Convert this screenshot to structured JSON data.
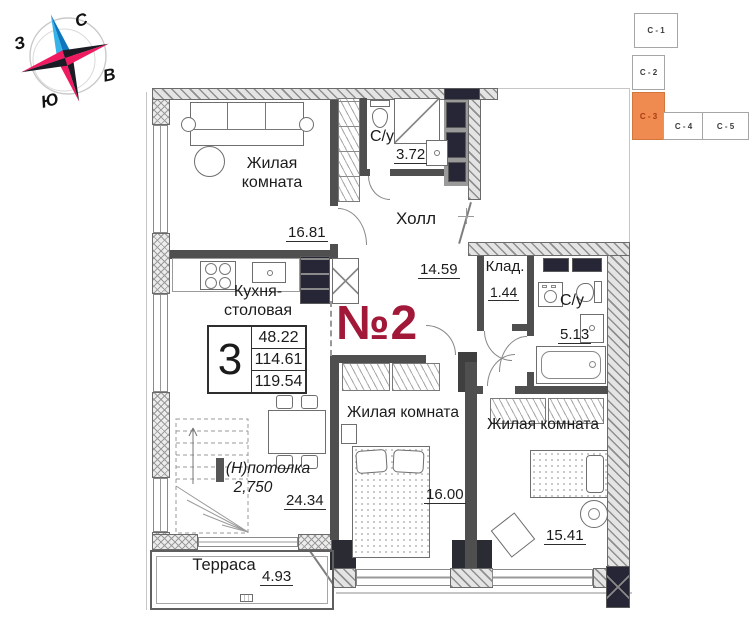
{
  "compass": {
    "north": "С",
    "west": "З",
    "east": "В",
    "south": "Ю"
  },
  "building_scheme": {
    "sections": [
      {
        "label": "С - 1",
        "active": false
      },
      {
        "label": "С - 2",
        "active": false
      },
      {
        "label": "С - 3",
        "active": true
      },
      {
        "label": "С - 4",
        "active": false
      },
      {
        "label": "С - 5",
        "active": false
      }
    ],
    "active_color": "#ef8a50"
  },
  "plan": {
    "apartment_number": "№2",
    "accent_color": "#a21838",
    "rooms": {
      "living1": {
        "label": "Жилая комната",
        "area": "16.81"
      },
      "bath1": {
        "label": "С/у",
        "area": "3.72"
      },
      "hall": {
        "label": "Холл",
        "area": "14.59"
      },
      "storage": {
        "label": "Клад.",
        "area": "1.44"
      },
      "bath2": {
        "label": "С/у",
        "area": "5.13"
      },
      "kitchen": {
        "label": "Кухня-столовая",
        "area": "24.34"
      },
      "bedroom1": {
        "label": "Жилая комната",
        "area": "16.00"
      },
      "bedroom2": {
        "label": "Жилая комната",
        "area": "15.41"
      },
      "terrace": {
        "label": "Терраса",
        "area": "4.93"
      }
    },
    "summary": {
      "rooms_count": "3",
      "values": [
        "48.22",
        "114.61",
        "119.54"
      ]
    },
    "ceiling": {
      "label": "(Н)потолка",
      "height": "2,750"
    }
  }
}
